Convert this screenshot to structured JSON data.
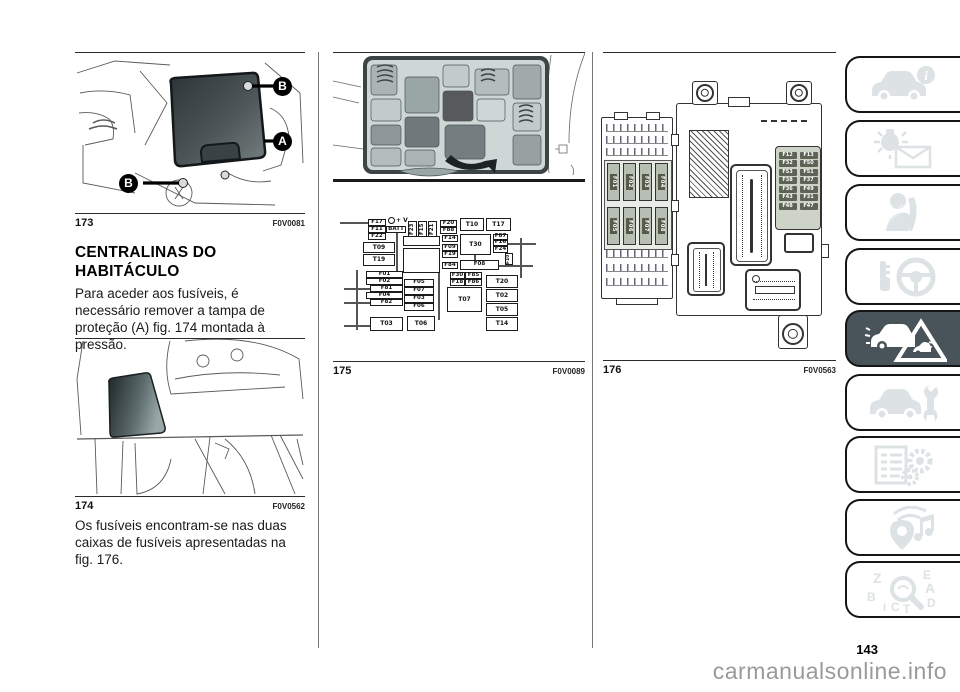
{
  "page": {
    "number": "143",
    "watermark": "carmanualsonline.info"
  },
  "colors": {
    "active_tab": "#49535a",
    "icon_gray": "#dde2e5",
    "watermark_gray": "#9a9a9a"
  },
  "left_column": {
    "figure_173": {
      "number": "173",
      "code": "F0V0081",
      "callout_a": "A",
      "callout_b": "B"
    },
    "heading": "CENTRALINAS DO HABITÁCULO",
    "paragraph_1": "Para aceder aos fusíveis, é necessário remover a tampa de proteção (A) fig. 174 montada à pressão.",
    "figure_174": {
      "number": "174",
      "code": "F0V0562"
    },
    "paragraph_2": "Os fusíveis encontram-se nas duas caixas de fusíveis apresentadas na fig. 176."
  },
  "middle_column": {
    "figure_175": {
      "number": "175",
      "code": "F0V0089",
      "labels": {
        "f17": "F17",
        "battery_terminal": "+ V",
        "f11": "F11",
        "batt": "BATT",
        "f22": "F22",
        "f23": "F23",
        "f15": "F15",
        "f21": "F21",
        "f20": "F20",
        "f88": "F88",
        "t10": "T10",
        "t17": "T17",
        "f14": "F14",
        "t30": "T30",
        "f87": "F87",
        "f16": "F16",
        "f24": "F24",
        "f09": "F09",
        "f19": "F19",
        "t09": "T09",
        "t19": "T19",
        "f84": "F84",
        "f10": "F10",
        "f08": "F08",
        "f30": "F30",
        "f85": "F85",
        "f18": "F18",
        "f86": "F86",
        "f01": "F01",
        "f02": "F02",
        "f05": "F05",
        "f81": "F81",
        "f07": "F07",
        "f04": "F04",
        "f03": "F03",
        "f82": "F82",
        "f06": "F06",
        "t07": "T07",
        "t20": "T20",
        "t02": "T02",
        "t05": "T05",
        "t14": "T14",
        "t03": "T03",
        "t06": "T06"
      }
    }
  },
  "right_column": {
    "figure_176": {
      "number": "176",
      "code": "F0V0563",
      "relay_fuses": [
        "F01",
        "F02",
        "F03",
        "F04",
        "F05",
        "F06",
        "F07",
        "F08"
      ],
      "panel_fuses": [
        [
          "F12",
          "F13"
        ],
        [
          "F32",
          "F50"
        ],
        [
          "F53",
          "F51"
        ],
        [
          "F38",
          "F37"
        ],
        [
          "F36",
          "F49"
        ],
        [
          "F43",
          "F31"
        ],
        [
          "F48",
          "F47"
        ]
      ]
    }
  },
  "sidebar": {
    "tabs": [
      {
        "name": "vehicle-info",
        "active": false
      },
      {
        "name": "warning-lights-messages",
        "active": false
      },
      {
        "name": "safety",
        "active": false
      },
      {
        "name": "starting-driving",
        "active": false
      },
      {
        "name": "emergency",
        "active": true
      },
      {
        "name": "servicing-maintenance",
        "active": false
      },
      {
        "name": "technical-data",
        "active": false
      },
      {
        "name": "multimedia",
        "active": false
      },
      {
        "name": "alphabetical-index",
        "active": false
      }
    ]
  }
}
